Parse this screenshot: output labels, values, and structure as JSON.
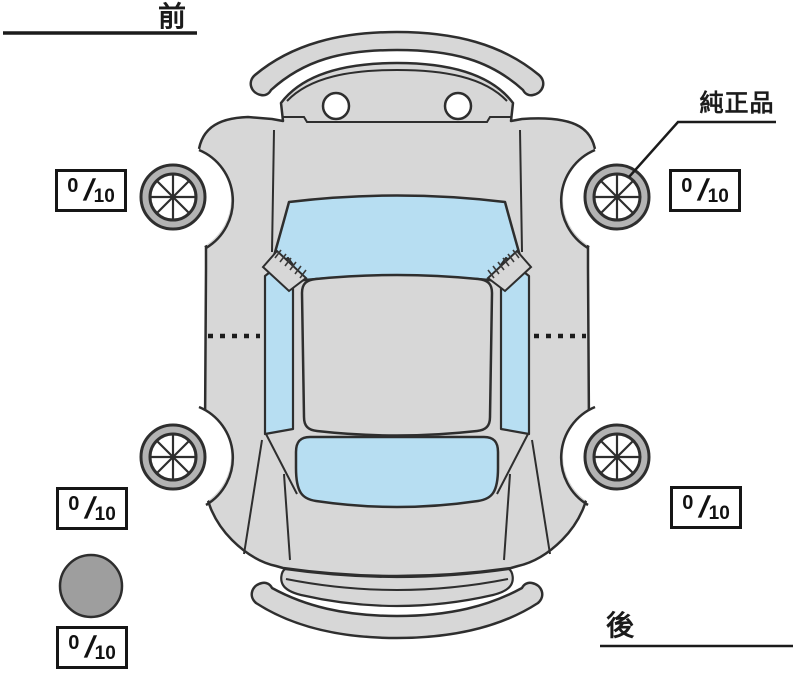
{
  "labels": {
    "front": "前",
    "rear": "後",
    "genuine_part": "純正品"
  },
  "tread": {
    "front_left": {
      "value": "0",
      "separator": "/",
      "max": "10"
    },
    "front_right": {
      "value": "0",
      "separator": "/",
      "max": "10"
    },
    "rear_left": {
      "value": "0",
      "separator": "/",
      "max": "10"
    },
    "rear_right": {
      "value": "0",
      "separator": "/",
      "max": "10"
    },
    "spare": {
      "value": "0",
      "separator": "/",
      "max": "10"
    }
  },
  "icons": {
    "car": "car-top-view",
    "wheel": "wheel-icon",
    "spare": "spare-tire-icon"
  },
  "colors": {
    "background": "#ffffff",
    "body": "#d7d7d7",
    "window": "#b7def2",
    "tire_ring": "#b3b3b3",
    "spare_tire": "#9e9e9e",
    "outline": "#2e2e2e"
  }
}
